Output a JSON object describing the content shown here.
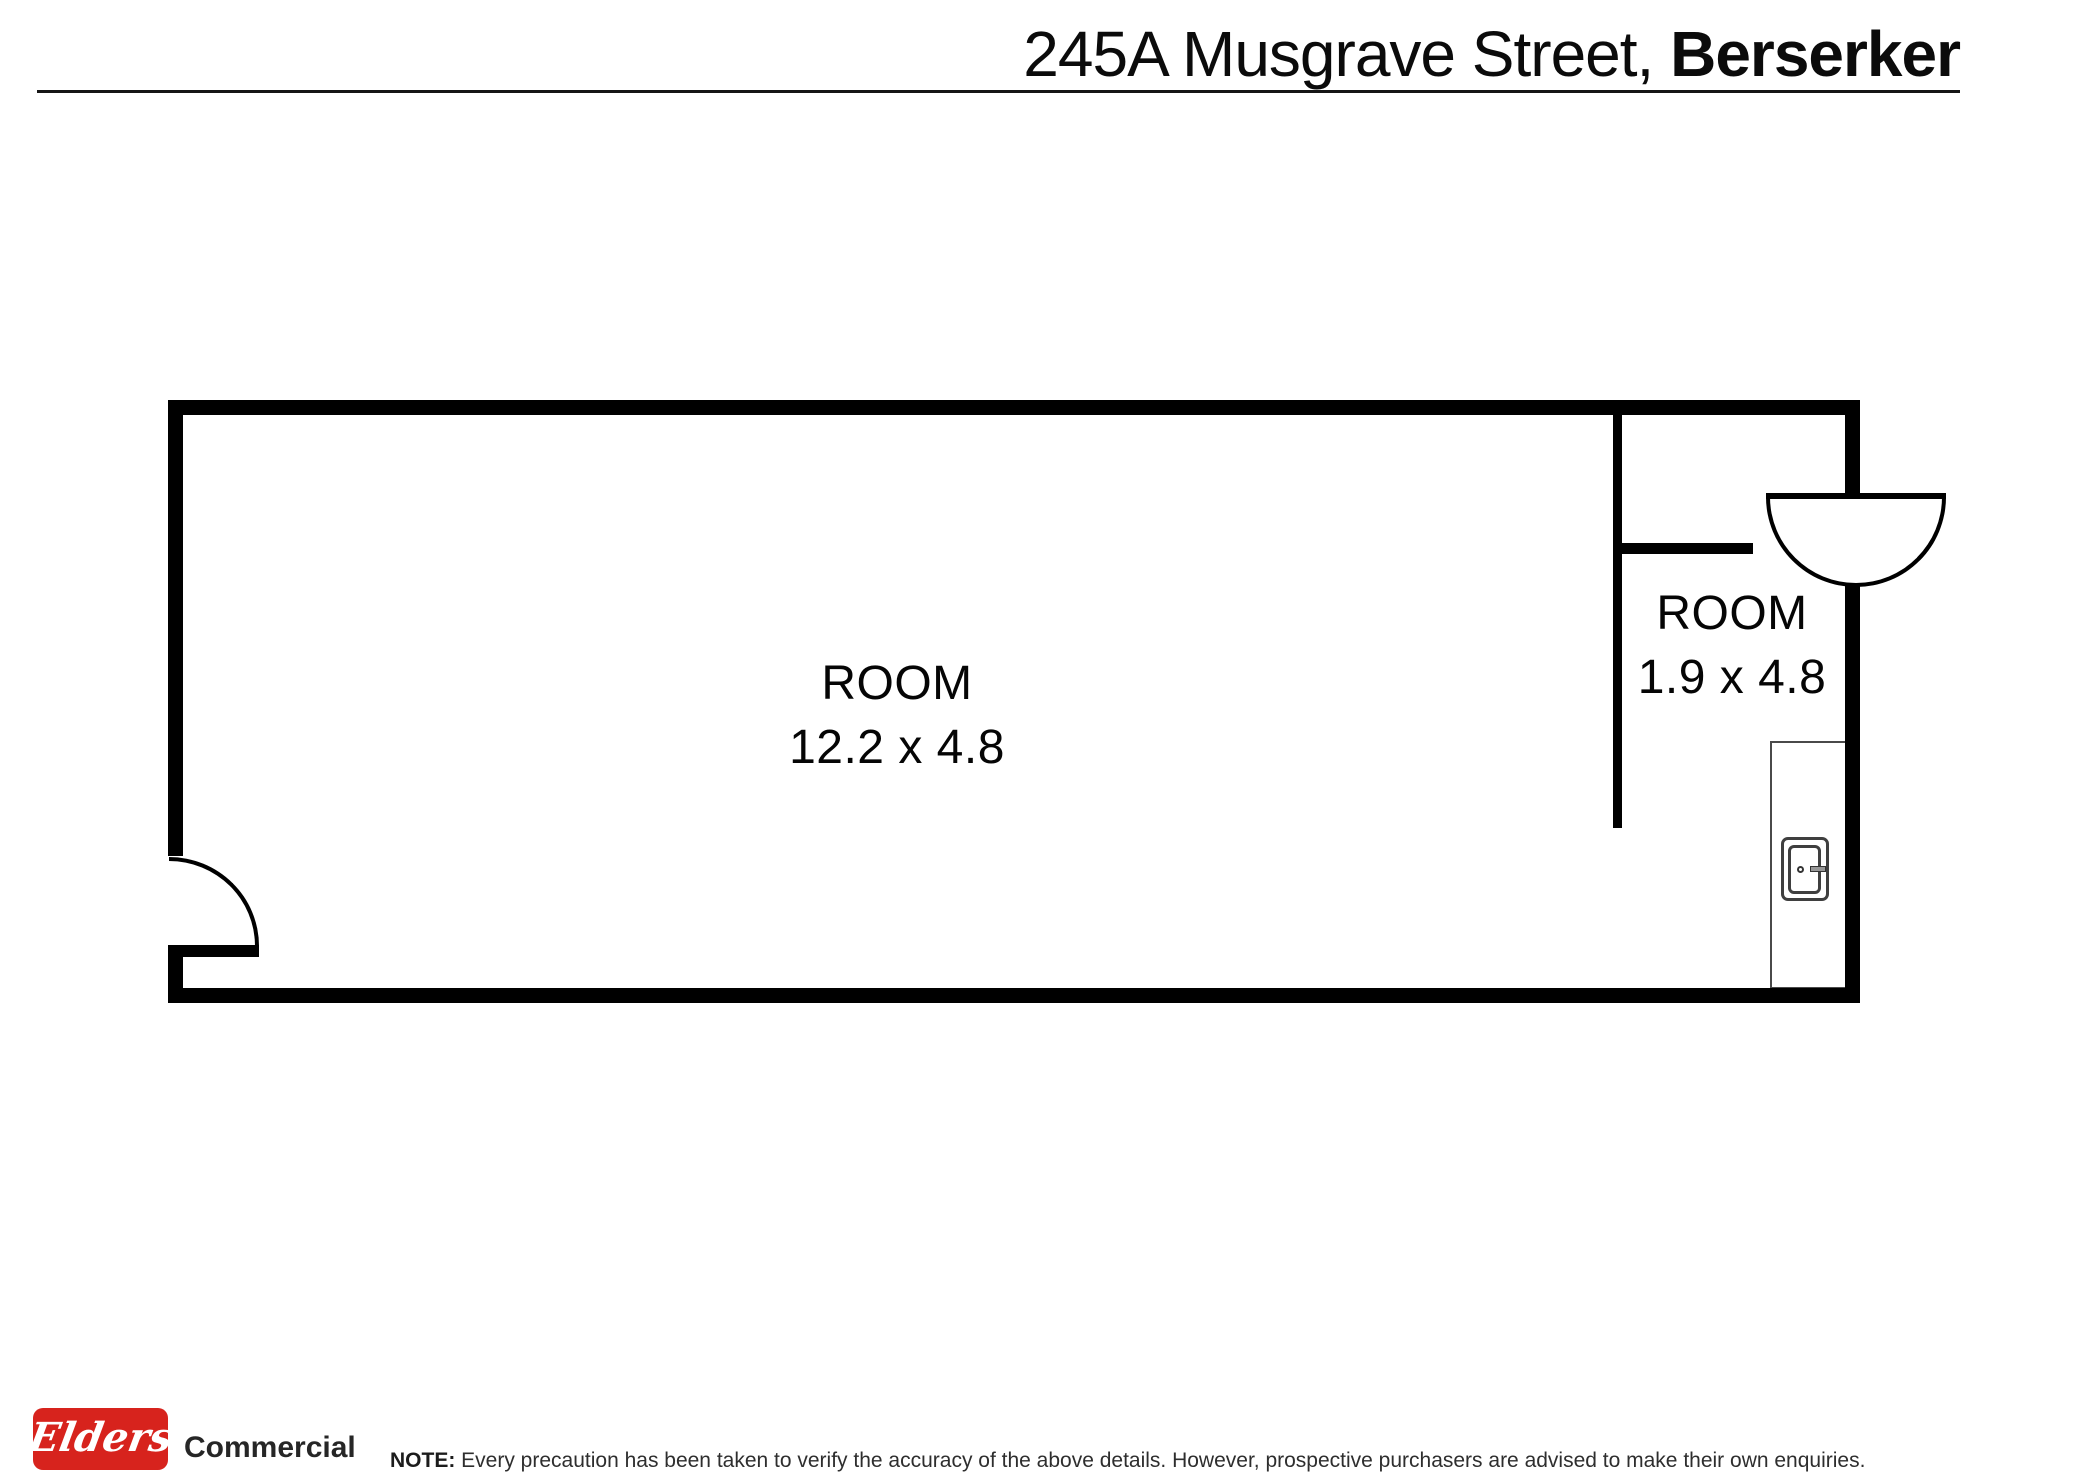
{
  "header": {
    "address_light": "245A Musgrave Street, ",
    "address_bold": "Berserker"
  },
  "floorplan": {
    "rooms": [
      {
        "name": "ROOM",
        "dimensions": "12.2 x 4.8"
      },
      {
        "name": "ROOM",
        "dimensions": "1.9 x 4.8"
      }
    ],
    "icons": [
      "door-swing-arc-quarter",
      "door-swing-arc-half",
      "meter-box-icon"
    ]
  },
  "footer": {
    "logo_text": "Elders",
    "logo_subtext": "Commercial",
    "note_label": "NOTE:",
    "note_text": " Every precaution has been taken to verify the accuracy of the above details. However, prospective purchasers are advised to make their own enquiries.",
    "brand_red": "#d7231d"
  }
}
